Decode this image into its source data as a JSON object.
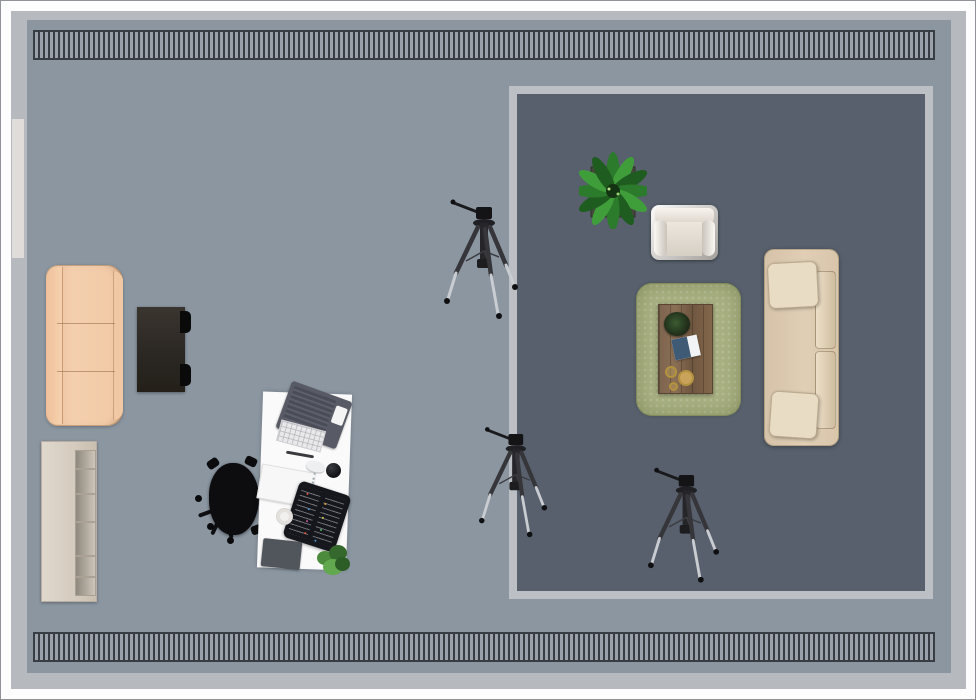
{
  "view": {
    "type": "floor-plan-top-view",
    "room": "studio living room with photo tripods"
  },
  "colors": {
    "page_bg": "#fdfdfd",
    "frame_border": "#8f9296",
    "wall": "#b6babe",
    "floor": "#8b96a1",
    "dark_zone": "#57606c",
    "dark_zone_border": "#bcc0c4",
    "window": "#e0dcd9",
    "radiator_dark": "#383d43",
    "radiator_light": "#9aa1aa",
    "desk": "#fbfafa",
    "chair": "#0d0d10",
    "rug": "#a9b183",
    "tripod_light": "#c9ccd1"
  },
  "items": {
    "room_frame": {
      "x": 10,
      "y": 10,
      "w": 955,
      "h": 678
    },
    "radiator_top": {
      "x": 32,
      "y": 29,
      "w": 902,
      "h": 30
    },
    "radiator_bottom": {
      "x": 32,
      "y": 631,
      "w": 902,
      "h": 30
    },
    "window_left": {
      "x": 10,
      "y": 117,
      "w": 14,
      "h": 141
    },
    "dark_zone": {
      "x": 508,
      "y": 85,
      "w": 424,
      "h": 513
    },
    "sofa_left": {
      "x": 45,
      "y": 264,
      "w": 77,
      "h": 161
    },
    "side_table": {
      "x": 136,
      "y": 306,
      "w": 48,
      "h": 85
    },
    "bookshelf": {
      "x": 40,
      "y": 440,
      "w": 56,
      "h": 161
    },
    "desk": {
      "x": 259,
      "y": 392,
      "w": 89,
      "h": 176,
      "rot": 2
    },
    "office_chair": {
      "x": 200,
      "y": 452,
      "w": 66,
      "h": 98
    },
    "laptop": {
      "x": 281,
      "y": 389,
      "w": 64,
      "h": 50,
      "rot": 20
    },
    "keyboard": {
      "x": 277,
      "y": 424,
      "w": 46,
      "h": 22,
      "rot": 15
    },
    "pen": {
      "x": 285,
      "y": 452,
      "w": 28,
      "h": 3,
      "rot": 10
    },
    "papers": {
      "x": 258,
      "y": 467,
      "w": 54,
      "h": 35,
      "rot": 10
    },
    "mouse": {
      "x": 305,
      "y": 460,
      "w": 19,
      "h": 11,
      "rot": 15
    },
    "ball": {
      "x": 325,
      "y": 462,
      "w": 15,
      "h": 15
    },
    "pen_roll": {
      "x": 289,
      "y": 486,
      "w": 54,
      "h": 59,
      "rot": 18
    },
    "cup": {
      "x": 275,
      "y": 507,
      "w": 17,
      "h": 17
    },
    "notebook_dark": {
      "x": 261,
      "y": 539,
      "w": 39,
      "h": 28,
      "rot": 6
    },
    "desk_plant": {
      "x": 314,
      "y": 544,
      "w": 36,
      "h": 31
    },
    "plant_large": {
      "x": 578,
      "y": 150,
      "w": 68,
      "h": 78
    },
    "armchair": {
      "x": 650,
      "y": 204,
      "w": 67,
      "h": 55
    },
    "rug": {
      "x": 635,
      "y": 282,
      "w": 105,
      "h": 133
    },
    "coffee_table": {
      "x": 657,
      "y": 303,
      "w": 55,
      "h": 90
    },
    "table_plant": {
      "x": 663,
      "y": 311,
      "w": 26,
      "h": 24
    },
    "magazine": {
      "x": 672,
      "y": 336,
      "w": 26,
      "h": 21,
      "rot": -12
    },
    "coaster_1": {
      "x": 664,
      "y": 365,
      "w": 12,
      "h": 12
    },
    "coaster_2": {
      "x": 677,
      "y": 369,
      "w": 16,
      "h": 16
    },
    "coaster_3": {
      "x": 668,
      "y": 381,
      "w": 9,
      "h": 9
    },
    "sofa_right": {
      "x": 763,
      "y": 248,
      "w": 75,
      "h": 197
    },
    "tripod_a": {
      "x": 443,
      "y": 192,
      "w": 76,
      "h": 130
    },
    "tripod_b": {
      "x": 478,
      "y": 418,
      "w": 70,
      "h": 124
    },
    "tripod_c": {
      "x": 647,
      "y": 460,
      "w": 73,
      "h": 126
    }
  }
}
